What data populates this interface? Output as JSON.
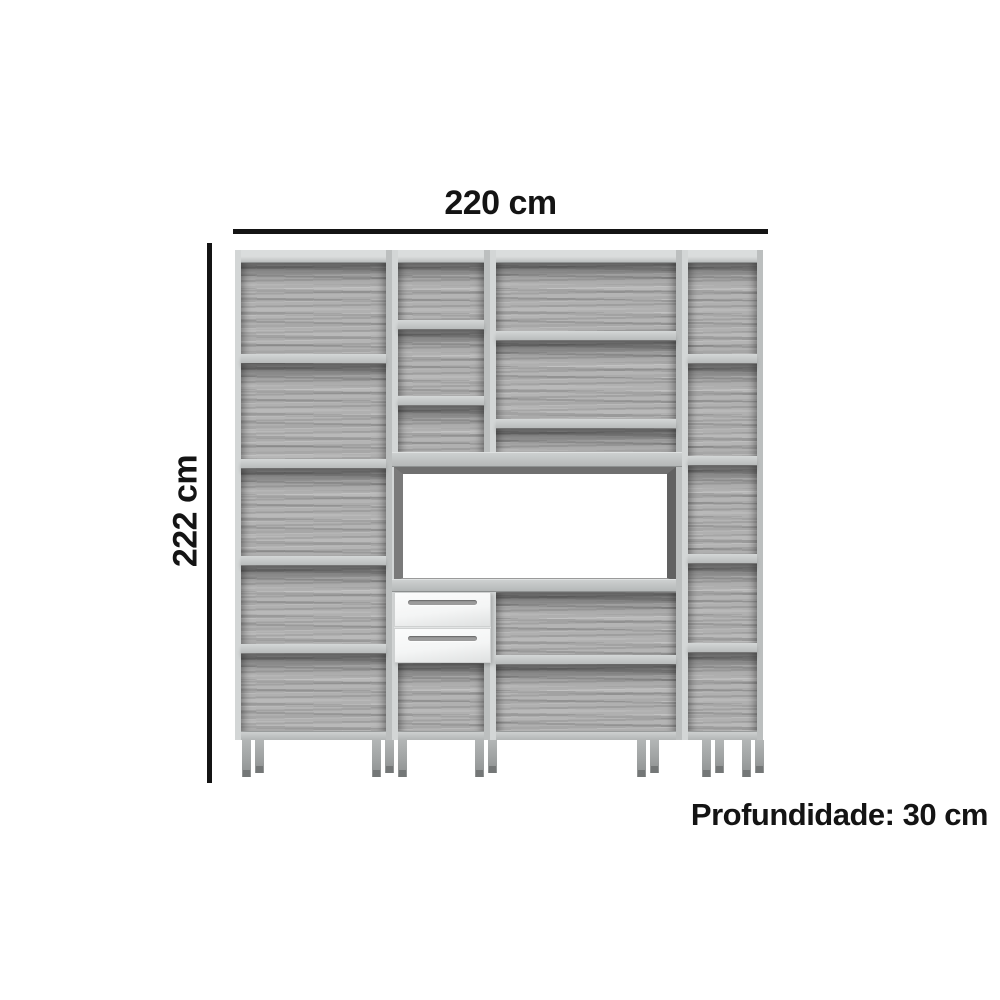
{
  "dimensions": {
    "width_label": "220 cm",
    "height_label": "222 cm",
    "depth_label": "Profundidade: 30 cm"
  },
  "furniture": {
    "description": "4-module open kitchen shelving unit with stove niche",
    "module_count": 4,
    "drawer_count": 2,
    "stove_niche_count": 1
  },
  "colors": {
    "background": "#ffffff",
    "annotation": "#141414",
    "wood_base": "#adadad",
    "wood_edge": "#cdd0d0",
    "niche_frame": "#707070",
    "drawer_face": "#f4f5f5",
    "drawer_handle": "#9b9b9b",
    "leg": "#9da0a0"
  }
}
